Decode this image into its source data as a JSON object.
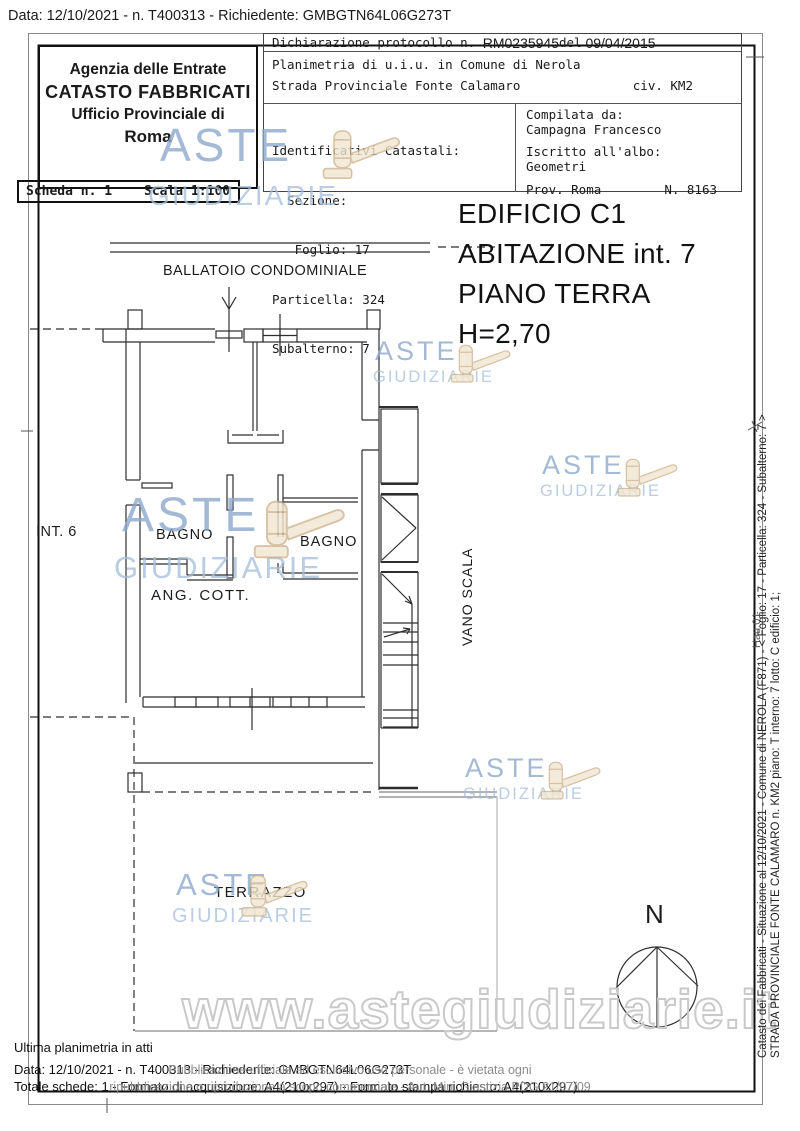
{
  "header": {
    "data_line": "Data: 12/10/2021 - n. T400313 - Richiedente: GMBGTN64L06G273T"
  },
  "agency": {
    "line1": "Agenzia delle Entrate",
    "line2": "CATASTO FABBRICATI",
    "line3": "Ufficio Provinciale di",
    "line4": "Roma"
  },
  "scheda": {
    "scheda_label": "Scheda n. 1",
    "scala_label": "Scala 1:100"
  },
  "info_box": {
    "dichiarazione_label": "Dichiarazione protocollo n. ",
    "protocol_number": "RM0235945",
    "del_label": "del",
    "protocol_date": " 09/04/2015",
    "planimetria_line": "Planimetria di u.i.u. in Comune di Nerola",
    "street_line": "Strada Provinciale Fonte Calamaro",
    "civ": "civ. KM2",
    "identificativi": "Identificativi Catastali:",
    "sezione": "  Sezione:",
    "foglio": "   Foglio: 17",
    "particella": "Particella: 324",
    "subalterno": "Subalterno: 7",
    "compilata_da": "Compilata da:",
    "compilatore": "Campagna Francesco",
    "iscritto": "Iscritto all'albo:",
    "albo": "Geometri",
    "prov": "Prov. Roma",
    "numero_albo": "N. 8163"
  },
  "title_block": {
    "line1": "EDIFICIO C1",
    "line2": "ABITAZIONE int. 7",
    "line3": "PIANO TERRA",
    "line4": "H=2,70"
  },
  "plan": {
    "ballatoio": "BALLATOIO CONDOMINIALE",
    "int6": "INT. 6",
    "bagno_left": "BAGNO",
    "bagno_right": "BAGNO",
    "ang_cott": "ANG. COTT.",
    "vano_scala": "VANO SCALA",
    "terrazzo": "TERRAZZO",
    "north": "N"
  },
  "watermark": {
    "aste": "ASTE",
    "giudiziarie": "GIUDIZIARIE",
    "url": "www.astegiudiziarie.it",
    "blue": "#8ca8cb",
    "blue_light": "#a3bcda",
    "gavel_fill": "#f2e6d0",
    "gavel_stroke": "#cdb38e"
  },
  "side_text": {
    "line1": "Catasto dei Fabbricati - Situazione al 12/10/2021 - Comune di NEROLA (F871) - <  Foglio: 17 - Particella: 324 - Subalterno: 7 >",
    "line2": "STRADA PROVINCIALE FONTE CALAMARO n. KM2 piano: T interno: 7 lotto: C edificio: 1;",
    "overlay": "Hau.01"
  },
  "footer": {
    "ultima": "Ultima planimetria in atti",
    "data_line": "Data: 12/10/2021 - n. T400313 - Richiedente: GMBGTN64L06G273T",
    "totale_line": "Totale schede: 1 - Formato di acquisizione: A4(210x297)  - Formato stampa richiesto: A4(210x297)",
    "disclaimer1": "Pubblicazione ufficiale ad esclusivo uso personale - è vietata ogni",
    "disclaimer2": "ripubblicazione o riproduzione a scopo commerciale - Aut. Min. Giustizia PDG 21/07/09"
  }
}
